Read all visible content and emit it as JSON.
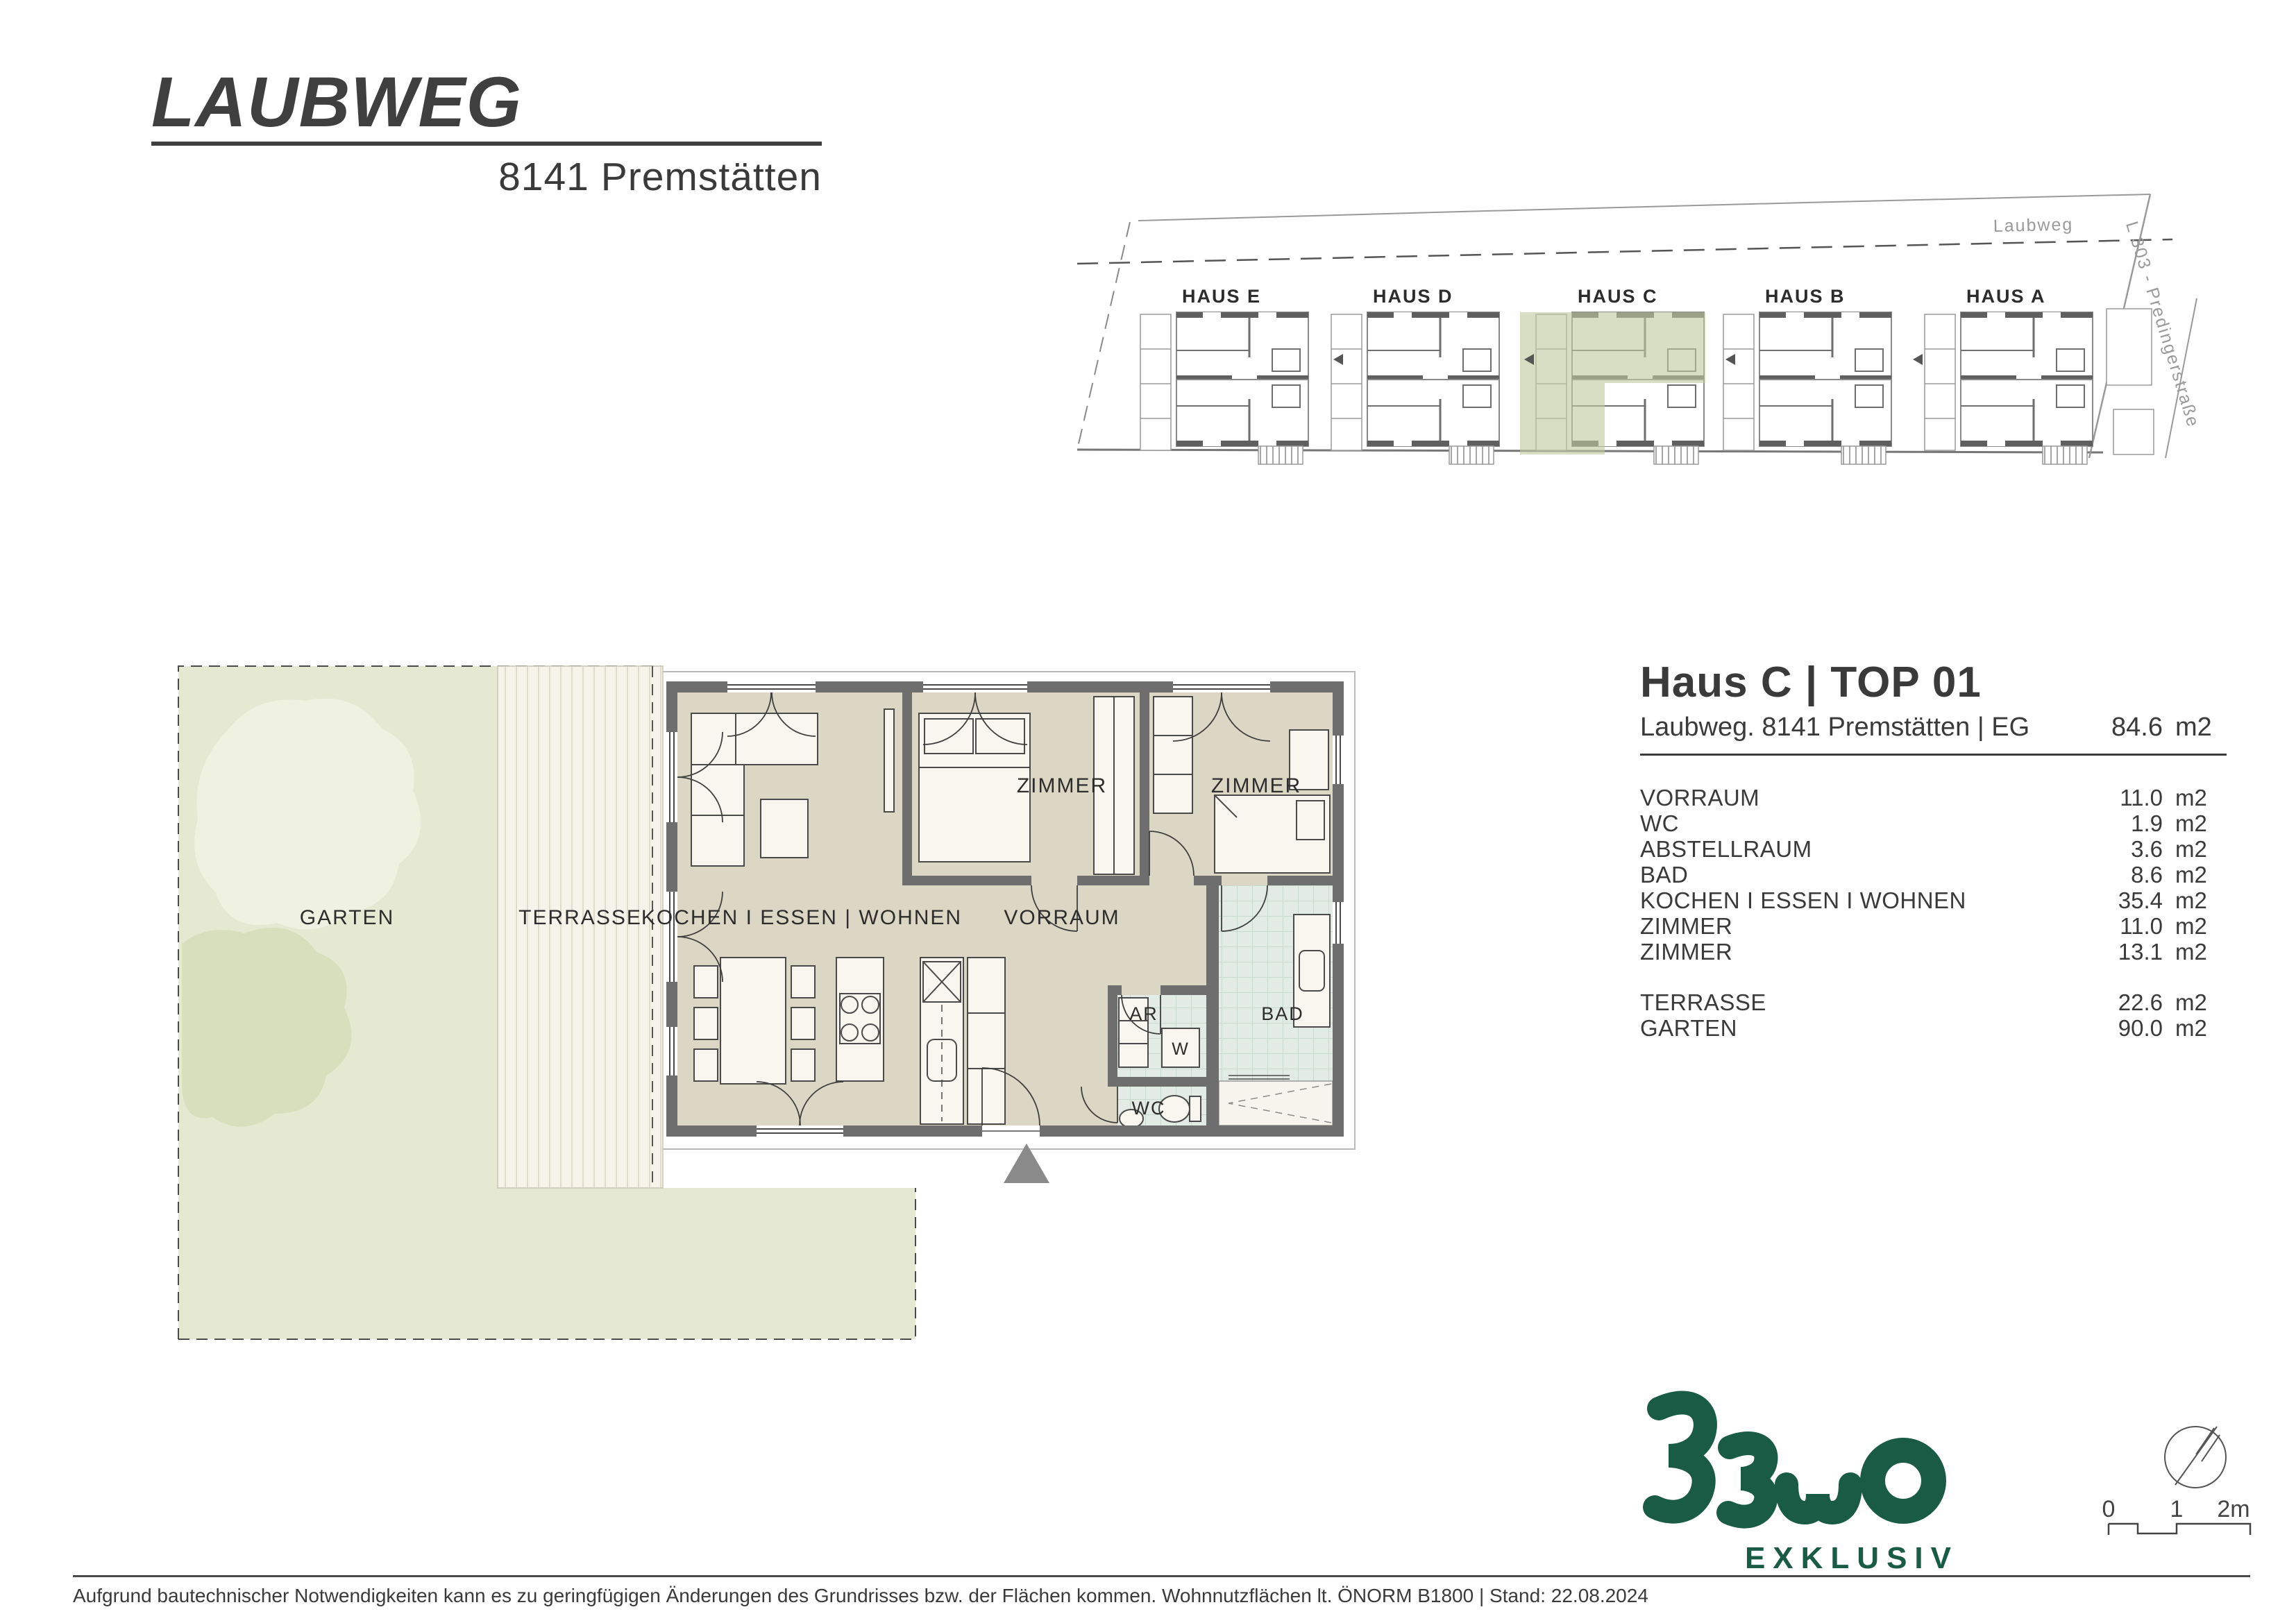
{
  "header": {
    "title": "LAUBWEG",
    "subtitle": "8141 Premstätten"
  },
  "site_plan": {
    "street_label": "Laubweg",
    "road_label": "L 303 - Predingerstraße",
    "houses": [
      {
        "label": "HAUS E"
      },
      {
        "label": "HAUS D"
      },
      {
        "label": "HAUS C"
      },
      {
        "label": "HAUS B"
      },
      {
        "label": "HAUS A"
      }
    ],
    "highlight_color": "#BFC9A0"
  },
  "floor_plan": {
    "labels": {
      "garten": "GARTEN",
      "terrasse": "TERRASSE",
      "kitchen": "KOCHEN I ESSEN | WOHNEN",
      "zimmer1": "ZIMMER",
      "zimmer2": "ZIMMER",
      "vorraum": "VORRAUM",
      "ar": "AR",
      "w": "W",
      "bad": "BAD",
      "wc": "WC"
    }
  },
  "unit_info": {
    "title": "Haus C | TOP 01",
    "address": "Laubweg. 8141 Premstätten | EG",
    "total_area": "84.6",
    "area_unit": "m2",
    "rooms": [
      {
        "label": "VORRAUM",
        "area": "11.0",
        "unit": "m2"
      },
      {
        "label": "WC",
        "area": "1.9",
        "unit": "m2"
      },
      {
        "label": "ABSTELLRAUM",
        "area": "3.6",
        "unit": "m2"
      },
      {
        "label": "BAD",
        "area": "8.6",
        "unit": "m2"
      },
      {
        "label": "KOCHEN I ESSEN I WOHNEN",
        "area": "35.4",
        "unit": "m2"
      },
      {
        "label": "ZIMMER",
        "area": "11.0",
        "unit": "m2"
      },
      {
        "label": "ZIMMER",
        "area": "13.1",
        "unit": "m2"
      }
    ],
    "outdoor": [
      {
        "label": "TERRASSE",
        "area": "22.6",
        "unit": "m2"
      },
      {
        "label": "GARTEN",
        "area": "90.0",
        "unit": "m2"
      }
    ]
  },
  "logo": {
    "name": "BEWO",
    "tagline": "EXKLUSIV",
    "color": "#1A5B45"
  },
  "scale_bar": {
    "labels": [
      "0",
      "1",
      "2m"
    ]
  },
  "footer": {
    "disclaimer": "Aufgrund bautechnischer Notwendigkeiten kann es zu geringfügigen Änderungen des Grundrisses bzw. der Flächen kommen. Wohnnutzflächen lt. ÖNORM B1800 | Stand: 22.08.2024"
  },
  "colors": {
    "logo_green": "#1A5B45",
    "wall_gray": "#6E6E6E",
    "floor_beige": "#DBD7C4",
    "tile_teal": "#E3EBE5",
    "garden_green": "#E5E9D2",
    "highlight_sage": "#BFC9A0"
  }
}
